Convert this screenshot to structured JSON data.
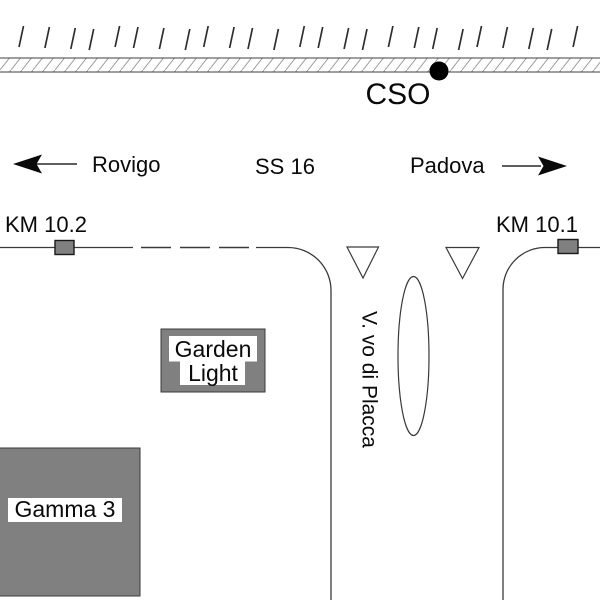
{
  "labels": {
    "cso": "CSO",
    "direction_left": "Rovigo",
    "road": "SS 16",
    "direction_right": "Padova",
    "km_left": "KM 10.2",
    "km_right": "KM 10.1",
    "street": "V. vo di Placca",
    "building_garden_line1": "Garden",
    "building_garden_line2": "Light",
    "building_gamma": "Gamma 3"
  },
  "colors": {
    "building_fill": "#808080",
    "km_marker_fill": "#808080",
    "line": "#3a3a3a",
    "hatch": "#9a9a9a",
    "cso_dot": "#000000",
    "background": "#ffffff",
    "text": "#0a0a0a"
  },
  "icons": {
    "arrow_left": "west-direction-arrow",
    "arrow_right": "east-direction-arrow",
    "yield_triangles": "give-way-triangle",
    "island": "traffic-island-ellipse",
    "railway": "hatched-railway-band"
  }
}
